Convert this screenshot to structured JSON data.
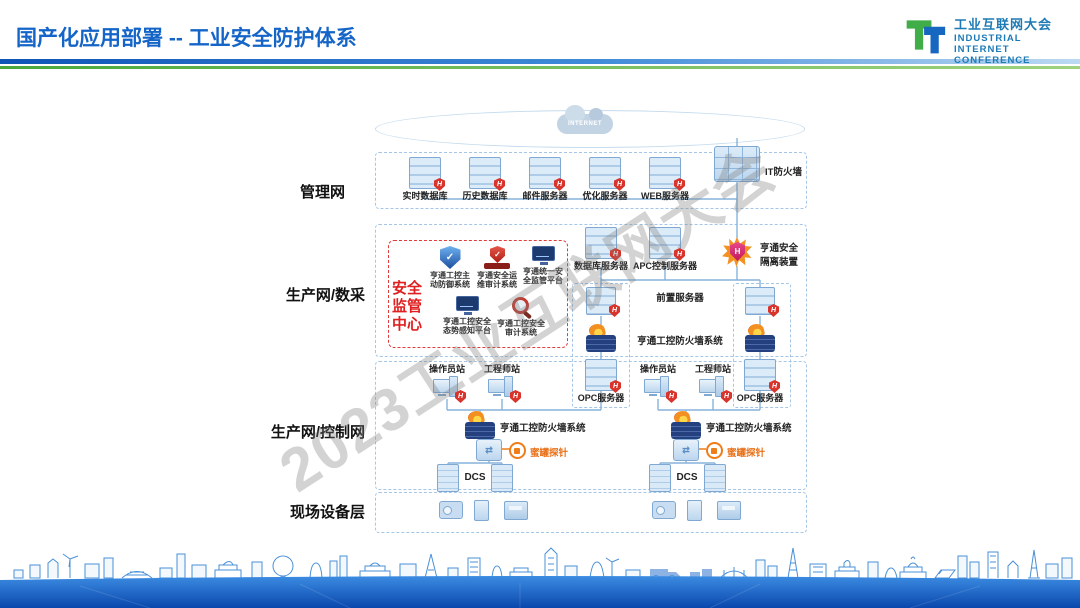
{
  "header": {
    "title": "国产化应用部署 -- 工业安全防护体系",
    "logo": {
      "cn": "工业互联网大会",
      "en1": "INDUSTRIAL",
      "en2": "INTERNET",
      "en3": "CONFERENCE"
    }
  },
  "watermark": "2023工业互联网大会",
  "cloud": {
    "label": "INTERNET"
  },
  "icons": {
    "shield_letter": "H",
    "check": "✓",
    "switch_glyph": "⇄"
  },
  "layers": {
    "management": {
      "name": "管理网",
      "servers": [
        "实时数据库",
        "历史数据库",
        "邮件服务器",
        "优化服务器",
        "WEB服务器"
      ],
      "it_firewall": "IT防火墙"
    },
    "production": {
      "name": "生产网/数采",
      "security_center": {
        "title": "安全监管中心",
        "items": [
          "亨通工控主动防御系统",
          "亨通安全运维审计系统",
          "亨通统一安全监管平台",
          "亨通工控安全态势感知平台",
          "亨通工控安全审计系统"
        ]
      },
      "database_server": "数据库服务器",
      "apc_server": "APC控制服务器",
      "isolation_device": "亨通安全隔离装置",
      "front_server": "前置服务器",
      "firewall_system": "亨通工控防火墙系统",
      "opc_server": "OPC服务器"
    },
    "control": {
      "name": "生产网/控制网",
      "operator_station": "操作员站",
      "engineer_station": "工程师站",
      "firewall_system": "亨通工控防火墙系统",
      "honeypot": "蜜罐探针",
      "dcs": "DCS"
    },
    "field": {
      "name": "现场设备层"
    }
  },
  "colors": {
    "accent_blue": "#1565c8",
    "green": "#5cb54e",
    "red": "#d9342b",
    "orange": "#ef7d1a",
    "navy": "#24407e",
    "box_dash": "#a5c6e6"
  }
}
